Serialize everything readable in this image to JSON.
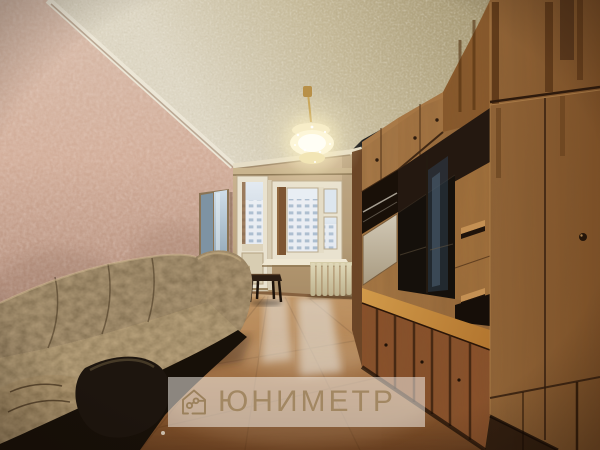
{
  "watermark": {
    "brand": "ЮНИМЕТР",
    "logo_icon": "house-route-logo-icon"
  },
  "scene": {
    "subject": "empty living room with balcony window, sofa and wooden wall unit",
    "palette": {
      "ceiling_light": "#ddd6c3",
      "ceiling_shade": "#9e906a",
      "wall_left": "#d5b4a1",
      "wall_left_shadow": "#8e6f60",
      "wall_back": "#c7b08d",
      "molding": "#ece6d6",
      "window_frame": "#e9e2cf",
      "sky": "#e3eaf1",
      "building": "#9fb3c8",
      "radiator": "#d9d0ad",
      "floor": "#a9743f",
      "floor_dark": "#6b4121",
      "floor_reflection": "#e6edf3",
      "unit_wood": "#96683a",
      "unit_wood_dark": "#6f4522",
      "unit_glass": "#15100b",
      "worktop": "#c98f45",
      "sofa_base": "#6e5638",
      "sofa_dark": "#241a10",
      "lamp_glow": "#fff7d9",
      "watermark_bar": "rgba(248,244,238,0.52)",
      "watermark_text": "#a28762"
    }
  }
}
